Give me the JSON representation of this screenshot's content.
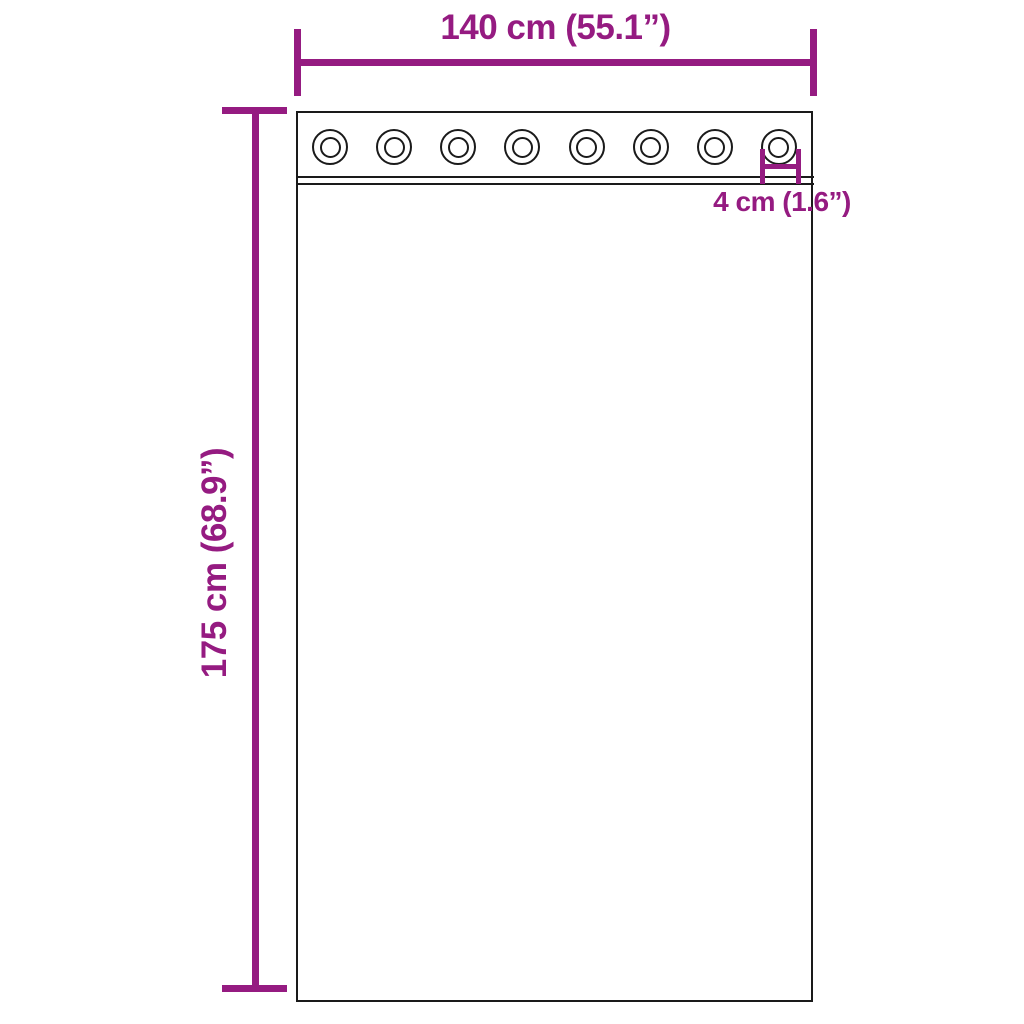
{
  "page": {
    "background": "#ffffff"
  },
  "colors": {
    "dimension": "#951B81",
    "outline": "#1a1a1a"
  },
  "curtain": {
    "grommet_count": 8
  },
  "dimensions": {
    "width": {
      "label": "140 cm (55.1”)"
    },
    "height": {
      "label": "175 cm (68.9”)"
    },
    "grommet": {
      "label": "4 cm (1.6”)"
    }
  }
}
